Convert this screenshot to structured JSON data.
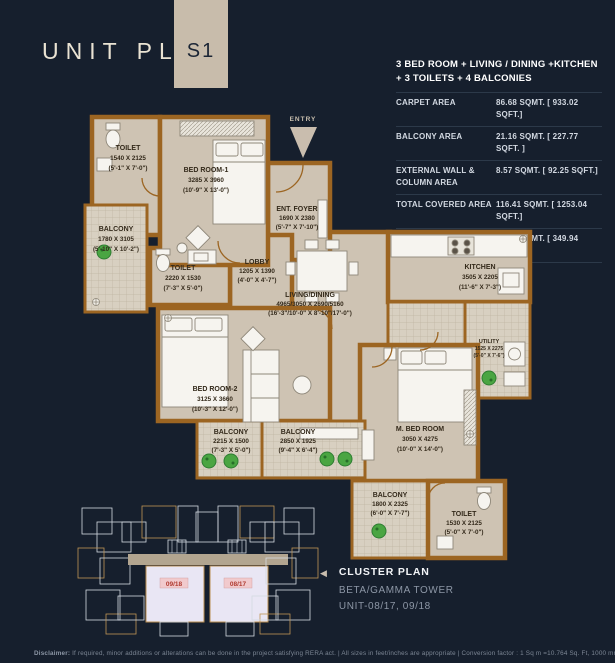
{
  "header": {
    "title": "UNIT PLAN",
    "badge": "S1"
  },
  "summary": {
    "title_line1": "3 BED ROOM + LIVING / DINING +KITCHEN",
    "title_line2": "+ 3 TOILETS + 4 BALCONIES",
    "rows": [
      {
        "label": "CARPET AREA",
        "value": "86.68 SQMT. [ 933.02 SQFT.]"
      },
      {
        "label": "BALCONY AREA",
        "value": "21.16 SQMT. [ 227.77 SQFT. ]"
      },
      {
        "label": "EXTERNAL WALL & COLUMN AREA",
        "value": "8.57 SQMT. [ 92.25 SQFT.]"
      },
      {
        "label": "TOTAL COVERED AREA",
        "value": "116.41 SQMT. [ 1253.04 SQFT.]"
      },
      {
        "label": "COMMON AREA",
        "value": "32.51 SQMT. [ 349.94 SQFT.]"
      }
    ]
  },
  "plan": {
    "entry_label": "ENTRY",
    "rooms": [
      {
        "name": "TOILET",
        "mm": "1540 X 2125",
        "ft": "(5'-1\" X 7'-0\")"
      },
      {
        "name": "BED ROOM-1",
        "mm": "3285 X 3960",
        "ft": "(10'-9\" X 13'-0\")"
      },
      {
        "name": "BALCONY",
        "mm": "1780 X 3105",
        "ft": "(5'-10\" X 10'-2\")"
      },
      {
        "name": "TOILET",
        "mm": "2220 X 1530",
        "ft": "(7'-3\" X 5'-0\")"
      },
      {
        "name": "LOBBY",
        "mm": "1205 X 1390",
        "ft": "(4'-0\" X 4'-7\")"
      },
      {
        "name": "ENT. FOYER",
        "mm": "1690 X 2380",
        "ft": "(5'-7\" X 7'-10\")"
      },
      {
        "name": "LIVING/DINING",
        "mm": "4965/3050 X 2690/5160",
        "ft": "(16'-3\"/10'-0\" X 8'-10\"/17'-0\")"
      },
      {
        "name": "KITCHEN",
        "mm": "3505 X 2205",
        "ft": "(11'-6\" X 7'-3\")"
      },
      {
        "name": "UTILITY",
        "mm": "1525 X 2275",
        "ft": "(5'-0\" X 7'-6\")"
      },
      {
        "name": "BED ROOM-2",
        "mm": "3125 X 3660",
        "ft": "(10'-3\" X 12'-0\")"
      },
      {
        "name": "BALCONY",
        "mm": "2215 X 1500",
        "ft": "(7'-3\" X 5'-0\")"
      },
      {
        "name": "BALCONY",
        "mm": "2850 X 1925",
        "ft": "(9'-4\" X 6'-4\")"
      },
      {
        "name": "M. BED ROOM",
        "mm": "3050 X 4275",
        "ft": "(10'-0\" X 14'-0\")"
      },
      {
        "name": "BALCONY",
        "mm": "1800 X 2325",
        "ft": "(6'-0\" X 7'-7\")"
      },
      {
        "name": "TOILET",
        "mm": "1530 X 2125",
        "ft": "(5'-0\" X 7'-0\")"
      }
    ]
  },
  "cluster": {
    "arrow": "◀",
    "title": "CLUSTER PLAN",
    "tower": "BETA/GAMMA TOWER",
    "unit": "UNIT-08/17, 09/18",
    "unit_labels": [
      "09/18",
      "08/17"
    ]
  },
  "disclaimer": {
    "prefix": "Disclaimer:",
    "text": "If required, minor additions or alterations can be done in the project satisfying RERA act.  |  All sizes in feet/inches are appropriate  |  Conversion factor : 1 Sq m =10.764 Sq. Ft, 1000 mm=3.28 Ft"
  },
  "colors": {
    "background": "#161f2d",
    "wall_brown": "#9c6522",
    "floor_beige": "#cec3b3",
    "accent_beige": "#c8bcab",
    "highlight_unit_pink": "#e9e6f4",
    "unit_label_red": "#b03a30",
    "plant_green": "#4aa542"
  }
}
